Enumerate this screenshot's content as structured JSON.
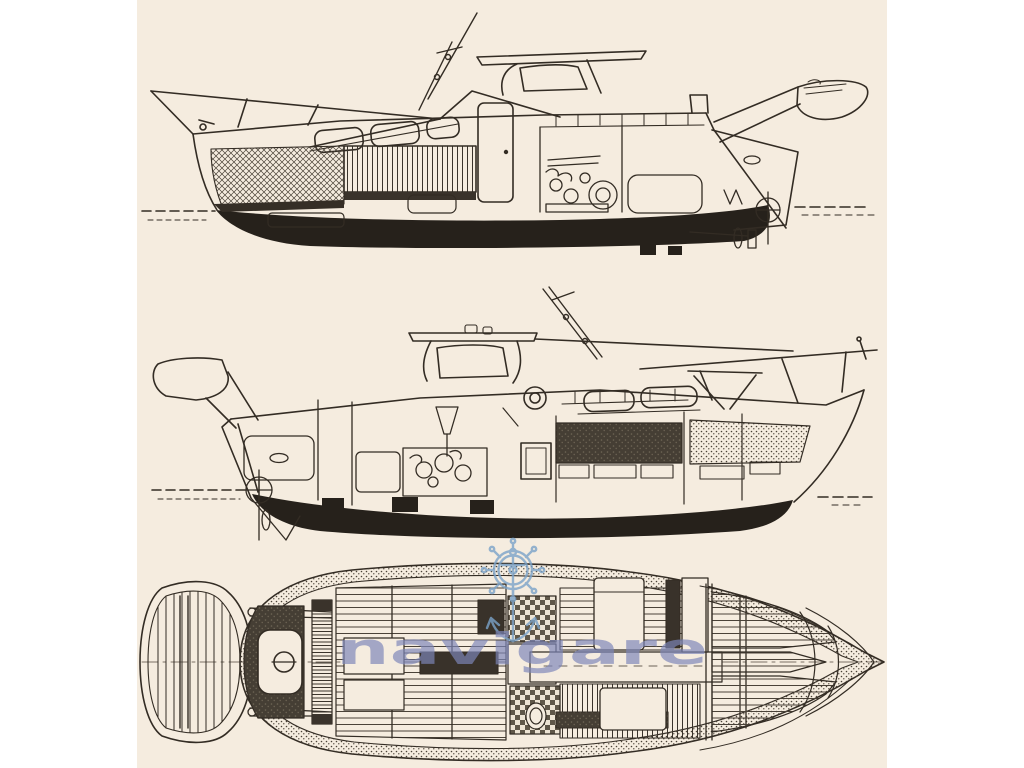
{
  "page": {
    "background_color": "#ffffff",
    "paper_color": "#f5ecdf",
    "ink_color": "#332c24",
    "hull_fill_color": "#26211b"
  },
  "watermark": {
    "text": "navigare",
    "text_color": "#7d86ba",
    "wheel_color": "#7ba3c9",
    "icon": "ship-wheel-anchor-icon"
  },
  "drawing": {
    "subject": "motor yacht general arrangement drawing",
    "views": [
      {
        "id": "profile-top",
        "description": "side profile cutaway, bow facing left"
      },
      {
        "id": "profile-middle",
        "description": "side profile cutaway, bow facing right"
      },
      {
        "id": "deck-plan",
        "description": "overhead deck plan with tender dinghy astern"
      }
    ]
  }
}
